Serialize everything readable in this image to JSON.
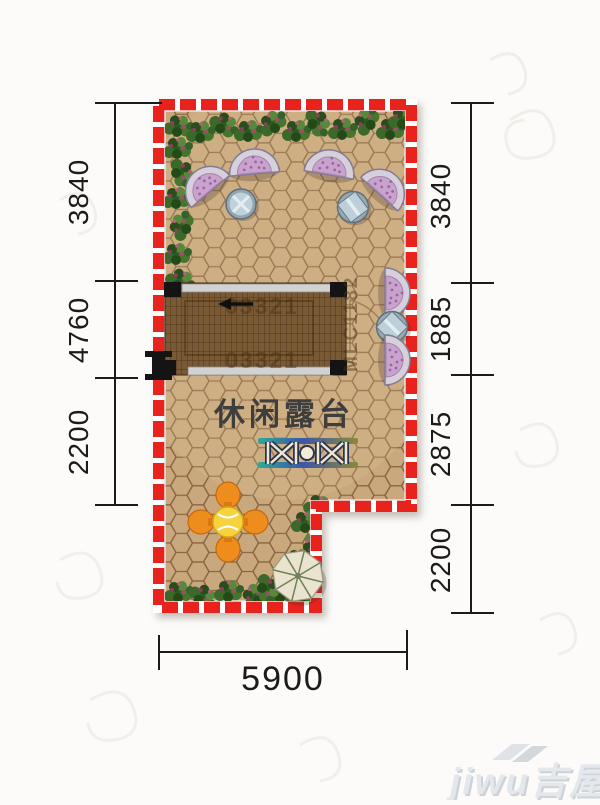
{
  "plan": {
    "room_label": "休闲露台",
    "stair_code_top": "03321",
    "stair_code_bottom": "03321",
    "stair_code_side": "MLC1182",
    "border_color": "#e8231e",
    "floor_color": "#c9a87d",
    "furniture_icons": [
      "lounge-chair-icon",
      "round-table-icon",
      "square-table-icon",
      "dining-set-icon",
      "parasol-icon",
      "bench-set-icon",
      "staircase-icon",
      "plant-icon"
    ]
  },
  "dimensions": {
    "left": [
      {
        "label": "3840"
      },
      {
        "label": "4760"
      },
      {
        "label": "2200"
      }
    ],
    "right": [
      {
        "label": "3840"
      },
      {
        "label": "1885"
      },
      {
        "label": "2875"
      },
      {
        "label": "2200"
      }
    ],
    "bottom": [
      {
        "label": "5900"
      }
    ]
  },
  "watermark": {
    "brand": "jiwu吉屋"
  }
}
